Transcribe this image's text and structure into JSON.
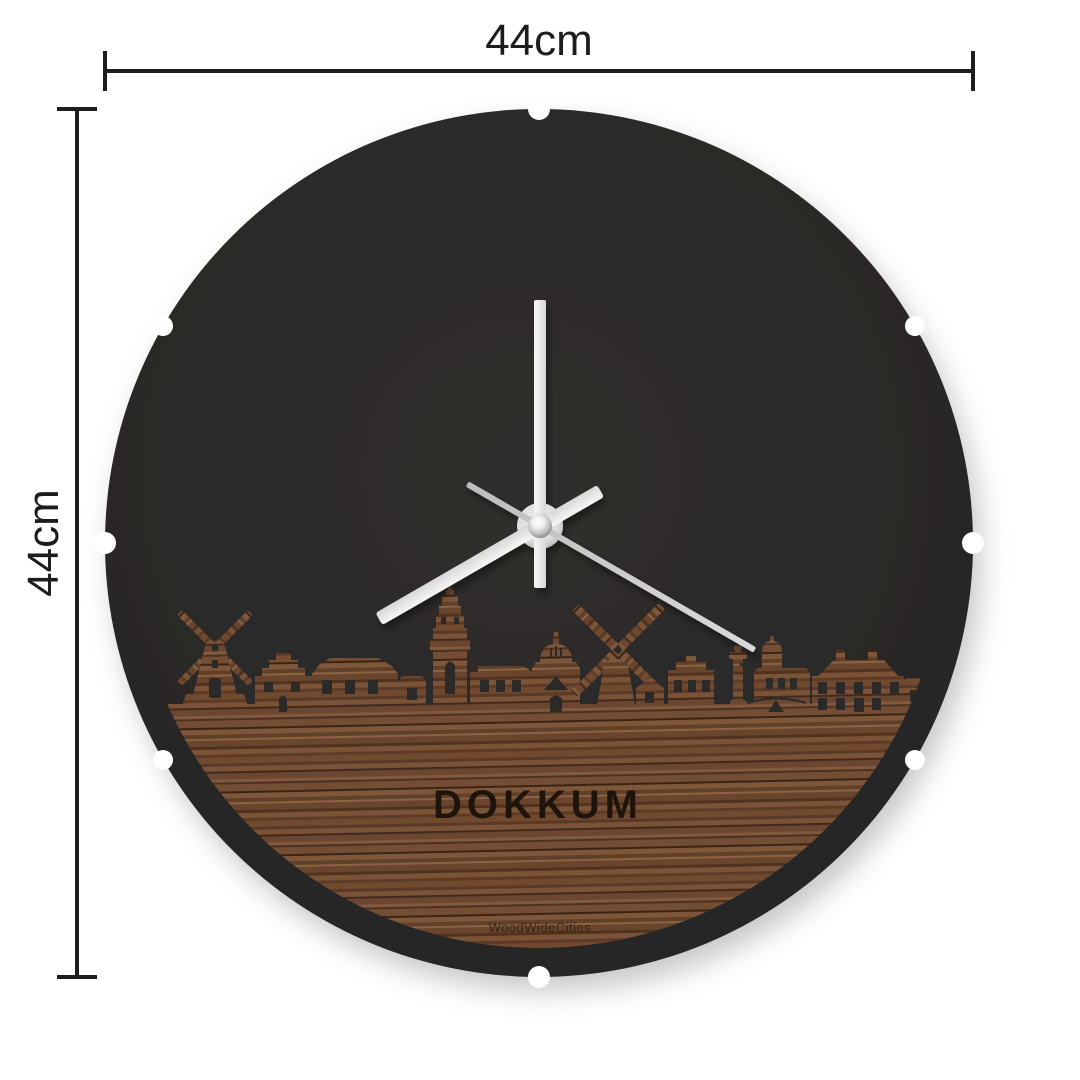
{
  "dimensions": {
    "top_label": "44cm",
    "left_label": "44cm"
  },
  "clock": {
    "city_name": "DOKKUM",
    "brand_name": "WoodWideCities",
    "hands": {
      "hour_transform": "rotate(240 540 526)",
      "minute_transform": "rotate(0 540 526)",
      "second_transform": "rotate(120 540 526)"
    },
    "colors": {
      "page_background": "#ffffff",
      "face": "#2b2a29",
      "wood_base": "#6e4a33",
      "wood_dark": "#3c2414",
      "wood_light": "#8a6244",
      "hands_light": "#ececec",
      "hand_second": "#c9c9c9",
      "dimension_lines": "#1d1d1d"
    },
    "skyline_elements": [
      "windmill",
      "stepped-gable-house",
      "canal-houses",
      "church-tower",
      "dome-building",
      "large-windmill",
      "stepped-facade",
      "statue-column",
      "cupola-house",
      "mansion"
    ]
  }
}
